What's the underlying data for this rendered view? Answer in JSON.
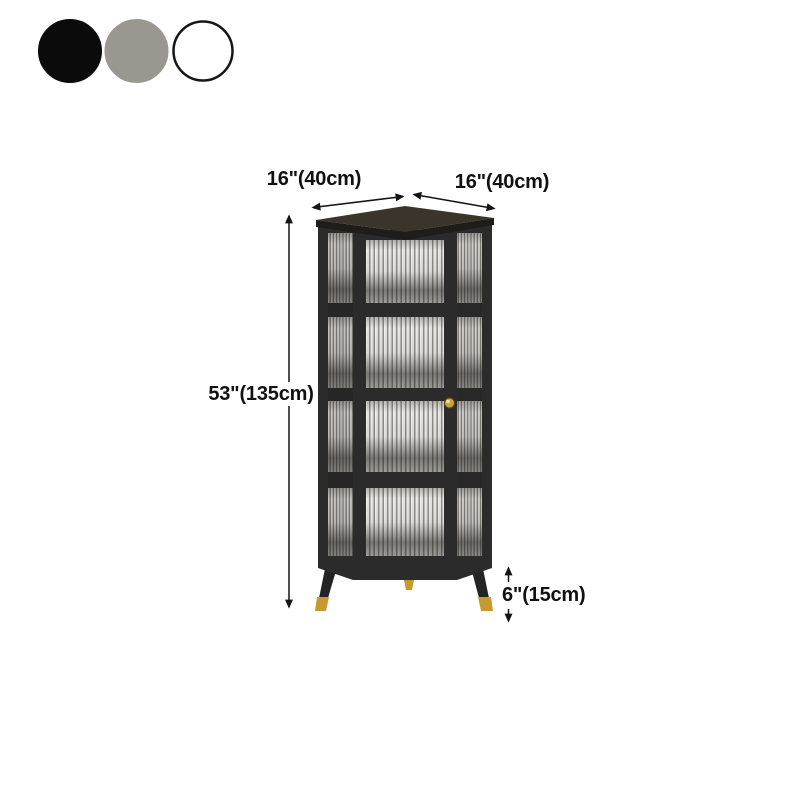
{
  "scene": {
    "background": "#ffffff",
    "description": "Corner display cabinet with ribbed glass panels, black frame and gold leg caps, annotated with product dimensions"
  },
  "color_options": {
    "items": [
      {
        "id": "black",
        "fill": "#0b0b0b",
        "border": "#0b0b0b"
      },
      {
        "id": "gray",
        "fill": "#9a9790",
        "border": "#9a9790"
      },
      {
        "id": "white",
        "fill": "#ffffff",
        "border": "#161616"
      }
    ]
  },
  "annotations": {
    "top_width_label": "16\"(40cm)",
    "top_depth_label": "16\"(40cm)",
    "height_label": "53\"(135cm)",
    "leg_height_label": "6\"(15cm)",
    "arrow_color": "#141414",
    "text_color": "#111111"
  },
  "cabinet": {
    "tier_count": 4,
    "frame_color": "#2b2b2b",
    "frame_dark_color": "#1f1d1a",
    "top_surface_color": "#3a342b",
    "glass_base_color": "#e4e2de",
    "glass_stripe_color": "#8e8d86",
    "glass_highlight_color": "#f6f5f2",
    "side_glass_base_color": "#d3d1cc",
    "side_glass_stripe_color": "#807f78",
    "shadow_color": "#141311",
    "knob_color": "#caa23b",
    "leg_color": "#242424",
    "leg_cap_color": "#c8992f"
  }
}
